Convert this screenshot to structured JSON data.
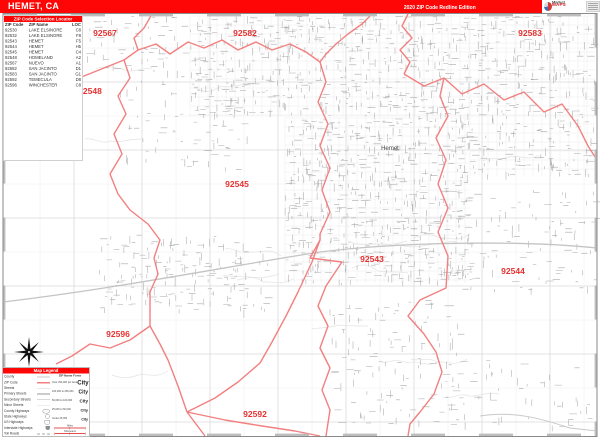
{
  "header": {
    "title": "HEMET, CA",
    "edition": "2020 ZIP Code Redline Edition",
    "logo": {
      "line1": "Market",
      "line2": "MAPS"
    }
  },
  "zip_index": {
    "title": "ZIP Code Selection Locator",
    "columns": [
      "ZIP Code",
      "ZIP Name",
      "LOC"
    ],
    "rows": [
      [
        "92530",
        "LAKE ELSINORE",
        "C8"
      ],
      [
        "92532",
        "LAKE ELSINORE",
        "F8"
      ],
      [
        "92543",
        "HEMET",
        "F5"
      ],
      [
        "92544",
        "HEMET",
        "H5"
      ],
      [
        "92545",
        "HEMET",
        "C4"
      ],
      [
        "92548",
        "HOMELAND",
        "A2"
      ],
      [
        "92567",
        "NUEVO",
        "A1"
      ],
      [
        "92582",
        "SAN JACINTO",
        "D1"
      ],
      [
        "92583",
        "SAN JACINTO",
        "G1"
      ],
      [
        "92592",
        "TEMECULA",
        "D8"
      ],
      [
        "92596",
        "WINCHESTER",
        "C8"
      ]
    ]
  },
  "map": {
    "city_label": {
      "text": "Hemet",
      "x": 390,
      "y": 150
    },
    "label_color": "#e63232",
    "boundary_color": "#f28080",
    "zip_labels": [
      {
        "code": "92567",
        "x": 105,
        "y": 36
      },
      {
        "code": "92582",
        "x": 245,
        "y": 36
      },
      {
        "code": "92583",
        "x": 530,
        "y": 36
      },
      {
        "code": "92548",
        "x": 90,
        "y": 94
      },
      {
        "code": "92545",
        "x": 237,
        "y": 187
      },
      {
        "code": "92543",
        "x": 372,
        "y": 262
      },
      {
        "code": "92544",
        "x": 513,
        "y": 274
      },
      {
        "code": "92596",
        "x": 118,
        "y": 337
      },
      {
        "code": "92592",
        "x": 255,
        "y": 417
      }
    ],
    "boundaries": [
      [
        [
          152,
          14
        ],
        [
          144,
          28
        ],
        [
          134,
          38
        ],
        [
          138,
          50
        ],
        [
          124,
          60
        ]
      ],
      [
        [
          124,
          60
        ],
        [
          104,
          68
        ],
        [
          84,
          76
        ],
        [
          62,
          82
        ],
        [
          4,
          88
        ]
      ],
      [
        [
          124,
          60
        ],
        [
          130,
          78
        ],
        [
          118,
          96
        ],
        [
          126,
          114
        ],
        [
          114,
          134
        ],
        [
          122,
          154
        ],
        [
          110,
          174
        ],
        [
          118,
          194
        ],
        [
          130,
          210
        ],
        [
          148,
          224
        ],
        [
          160,
          240
        ],
        [
          154,
          258
        ],
        [
          158,
          274
        ],
        [
          150,
          292
        ],
        [
          150,
          326
        ]
      ],
      [
        [
          150,
          326
        ],
        [
          130,
          340
        ],
        [
          110,
          348
        ],
        [
          90,
          344
        ],
        [
          72,
          356
        ],
        [
          56,
          364
        ]
      ],
      [
        [
          150,
          326
        ],
        [
          160,
          344
        ],
        [
          168,
          360
        ],
        [
          178,
          386
        ],
        [
          187,
          412
        ],
        [
          196,
          424
        ],
        [
          205,
          436
        ]
      ],
      [
        [
          320,
          240
        ],
        [
          312,
          262
        ],
        [
          298,
          292
        ],
        [
          286,
          316
        ],
        [
          272,
          342
        ],
        [
          260,
          363
        ],
        [
          238,
          382
        ],
        [
          215,
          398
        ],
        [
          187,
          412
        ]
      ],
      [
        [
          187,
          412
        ],
        [
          225,
          420
        ],
        [
          262,
          426
        ],
        [
          295,
          431
        ],
        [
          320,
          436
        ]
      ],
      [
        [
          372,
          14
        ],
        [
          362,
          24
        ],
        [
          348,
          34
        ],
        [
          336,
          44
        ],
        [
          326,
          54
        ],
        [
          320,
          62
        ],
        [
          326,
          82
        ],
        [
          318,
          102
        ],
        [
          328,
          124
        ],
        [
          320,
          146
        ],
        [
          330,
          168
        ],
        [
          322,
          190
        ],
        [
          330,
          212
        ],
        [
          320,
          234
        ],
        [
          320,
          240
        ],
        [
          310,
          258
        ],
        [
          342,
          262
        ],
        [
          326,
          286
        ],
        [
          318,
          306
        ],
        [
          328,
          326
        ],
        [
          320,
          348
        ],
        [
          330,
          368
        ],
        [
          322,
          390
        ],
        [
          330,
          410
        ],
        [
          326,
          436
        ]
      ],
      [
        [
          138,
          50
        ],
        [
          156,
          44
        ],
        [
          170,
          54
        ],
        [
          188,
          42
        ],
        [
          204,
          48
        ],
        [
          222,
          40
        ],
        [
          238,
          50
        ],
        [
          256,
          42
        ],
        [
          272,
          50
        ],
        [
          290,
          44
        ],
        [
          306,
          52
        ],
        [
          320,
          62
        ]
      ],
      [
        [
          408,
          14
        ],
        [
          402,
          26
        ],
        [
          412,
          38
        ],
        [
          400,
          50
        ],
        [
          410,
          62
        ],
        [
          404,
          74
        ]
      ],
      [
        [
          404,
          74
        ],
        [
          424,
          86
        ],
        [
          444,
          78
        ],
        [
          462,
          94
        ],
        [
          484,
          84
        ],
        [
          504,
          100
        ],
        [
          524,
          92
        ],
        [
          544,
          112
        ],
        [
          562,
          104
        ],
        [
          578,
          126
        ],
        [
          588,
          146
        ],
        [
          597,
          160
        ]
      ],
      [
        [
          444,
          78
        ],
        [
          440,
          96
        ],
        [
          448,
          116
        ],
        [
          436,
          138
        ],
        [
          446,
          160
        ],
        [
          438,
          184
        ],
        [
          448,
          208
        ],
        [
          438,
          232
        ],
        [
          448,
          256
        ],
        [
          446,
          288
        ],
        [
          420,
          300
        ],
        [
          408,
          316
        ],
        [
          424,
          334
        ],
        [
          436,
          352
        ],
        [
          442,
          372
        ],
        [
          434,
          394
        ],
        [
          420,
          412
        ],
        [
          410,
          424
        ],
        [
          408,
          436
        ]
      ]
    ]
  },
  "legend": {
    "title": "Map Legend",
    "items": [
      {
        "label": "County",
        "sym": "county"
      },
      {
        "label": "ZIP Code",
        "sym": "zip"
      },
      {
        "label": "Streets",
        "sym": "street"
      },
      {
        "label": "Primary Streets",
        "sym": "primary"
      },
      {
        "label": "Secondary Streets",
        "sym": "secondary"
      },
      {
        "label": "Minor Streets",
        "sym": "minor"
      },
      {
        "label": "County Highways",
        "sym": "county-hwy"
      },
      {
        "label": "State Highways",
        "sym": "state-hwy"
      },
      {
        "label": "US Highways",
        "sym": "us-hwy"
      },
      {
        "label": "Interstate Highways",
        "sym": "interstate"
      },
      {
        "label": "Toll Roads",
        "sym": "toll"
      }
    ],
    "fonts": {
      "heading": "ZIP Name Fonts",
      "bullet": "•",
      "rows": [
        {
          "label": "Over 250,000 per Area",
          "example": "City",
          "size": 12
        },
        {
          "label": "100,000 to 250,000",
          "example": "City",
          "size": 10
        },
        {
          "label": "50,000 to 100,000",
          "example": "City",
          "size": 9
        },
        {
          "label": "25,000 to 50,000",
          "example": "City",
          "size": 8
        },
        {
          "label": "Under 25,000",
          "example": "City",
          "size": 7
        }
      ]
    },
    "scales": [
      {
        "label": "Miles"
      },
      {
        "label": "Kilometers"
      }
    ]
  }
}
